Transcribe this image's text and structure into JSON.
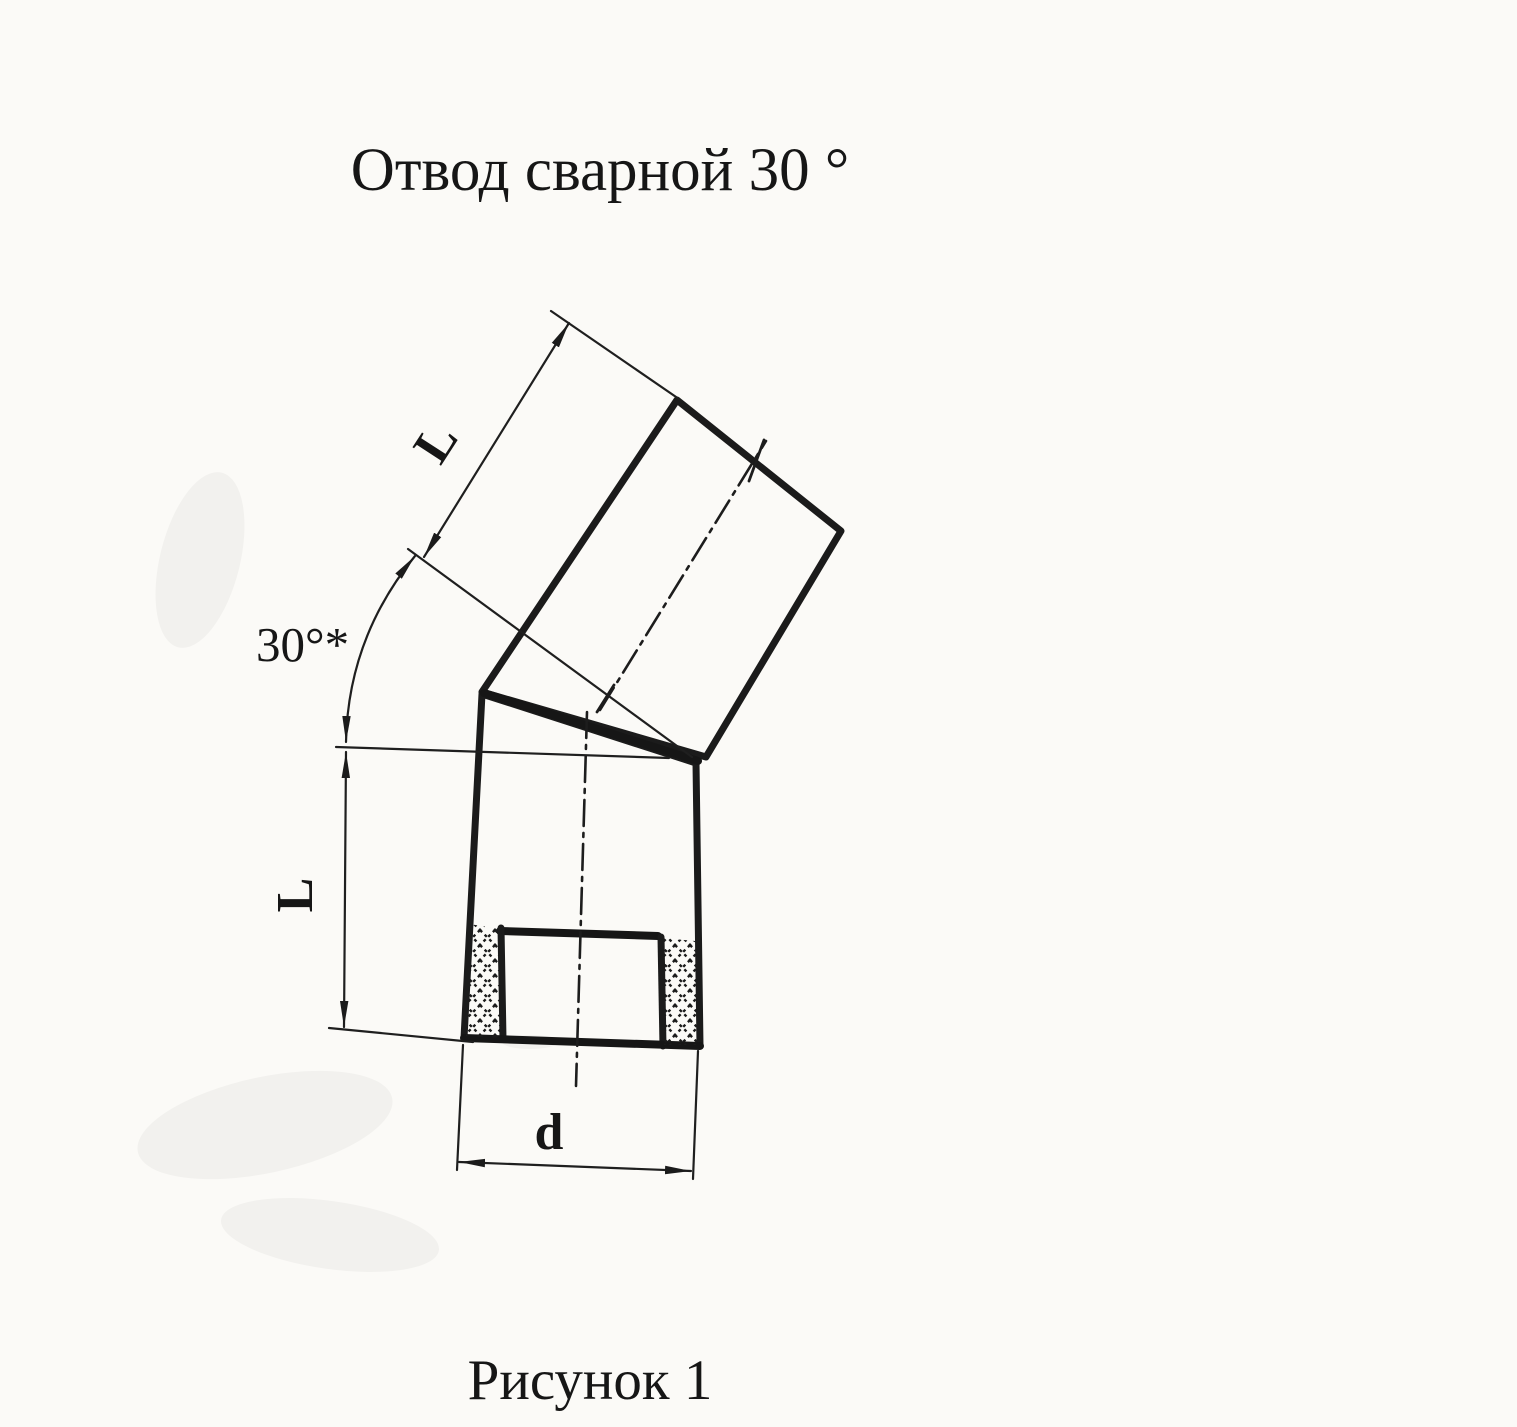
{
  "document": {
    "title": "Отвод сварной  30 °",
    "caption": "Рисунок 1"
  },
  "drawing": {
    "type": "technical-drawing",
    "subject": "welded pipe elbow, 30 degree",
    "labels": {
      "upper_segment_length": "L",
      "lower_segment_length": "L",
      "bend_angle": "30°*",
      "diameter": "d"
    },
    "colors": {
      "ink": "#1b1b1b",
      "paper": "#fbfaf7"
    }
  }
}
